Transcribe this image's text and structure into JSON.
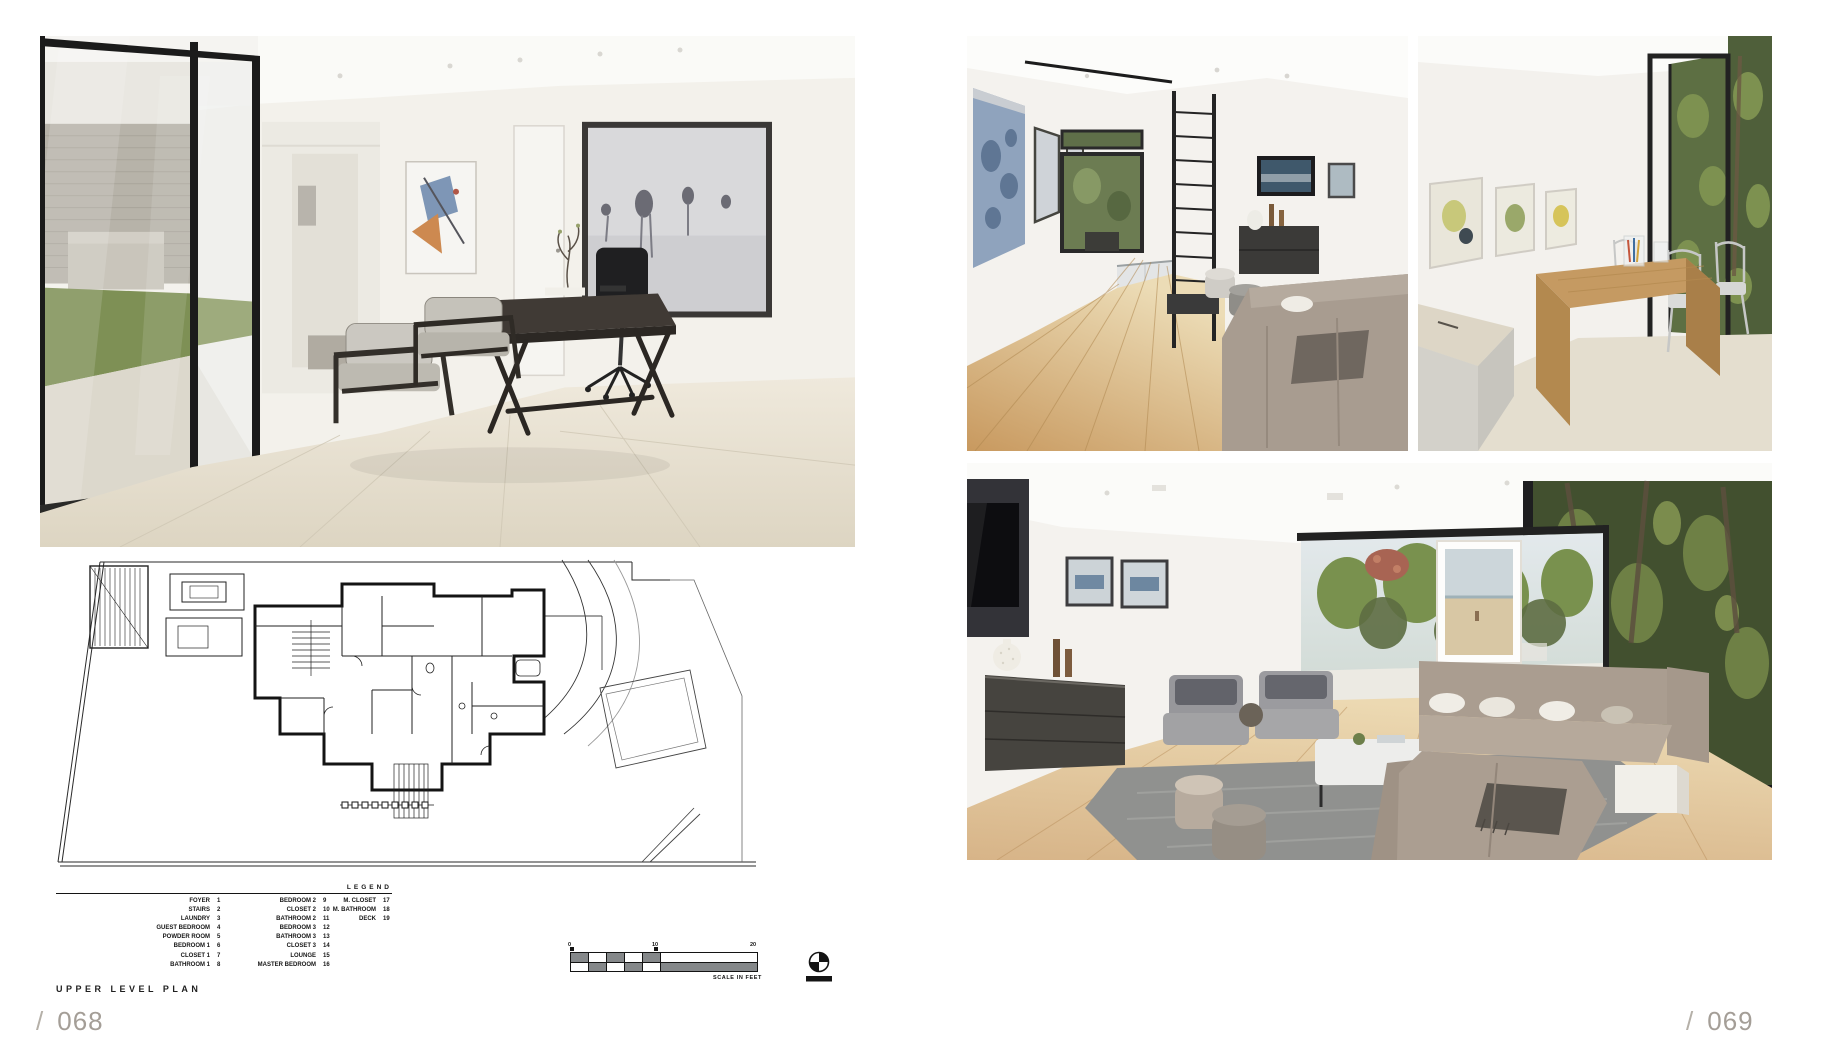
{
  "palette": {
    "paper": "#ffffff",
    "plan_ink": "#1c1c1c",
    "folio_gray": "#a49e97",
    "scale_gray": "#85888a"
  },
  "left_page": {
    "folio": {
      "slash": "/",
      "number": "068"
    },
    "plan_title": "UPPER LEVEL PLAN",
    "legend": {
      "title": "LEGEND",
      "columns": [
        {
          "items": [
            {
              "label": "FOYER",
              "num": "1"
            },
            {
              "label": "STAIRS",
              "num": "2"
            },
            {
              "label": "LAUNDRY",
              "num": "3"
            },
            {
              "label": "GUEST BEDROOM",
              "num": "4"
            },
            {
              "label": "POWDER ROOM",
              "num": "5"
            },
            {
              "label": "BEDROOM 1",
              "num": "6"
            },
            {
              "label": "CLOSET 1",
              "num": "7"
            },
            {
              "label": "BATHROOM 1",
              "num": "8"
            }
          ]
        },
        {
          "items": [
            {
              "label": "BEDROOM 2",
              "num": "9"
            },
            {
              "label": "CLOSET 2",
              "num": "10"
            },
            {
              "label": "BATHROOM 2",
              "num": "11"
            },
            {
              "label": "BEDROOM 3",
              "num": "12"
            },
            {
              "label": "BATHROOM 3",
              "num": "13"
            },
            {
              "label": "CLOSET 3",
              "num": "14"
            },
            {
              "label": "LOUNGE",
              "num": "15"
            },
            {
              "label": "MASTER BEDROOM",
              "num": "16"
            }
          ]
        },
        {
          "items": [
            {
              "label": "M. CLOSET",
              "num": "17"
            },
            {
              "label": "M. BATHROOM",
              "num": "18"
            },
            {
              "label": "DECK",
              "num": "19"
            }
          ]
        }
      ]
    },
    "scale_bar": {
      "ticks": [
        "0",
        "10",
        "20"
      ],
      "caption": "SCALE IN FEET"
    }
  },
  "right_page": {
    "folio": {
      "slash": "/",
      "number": "069"
    }
  }
}
